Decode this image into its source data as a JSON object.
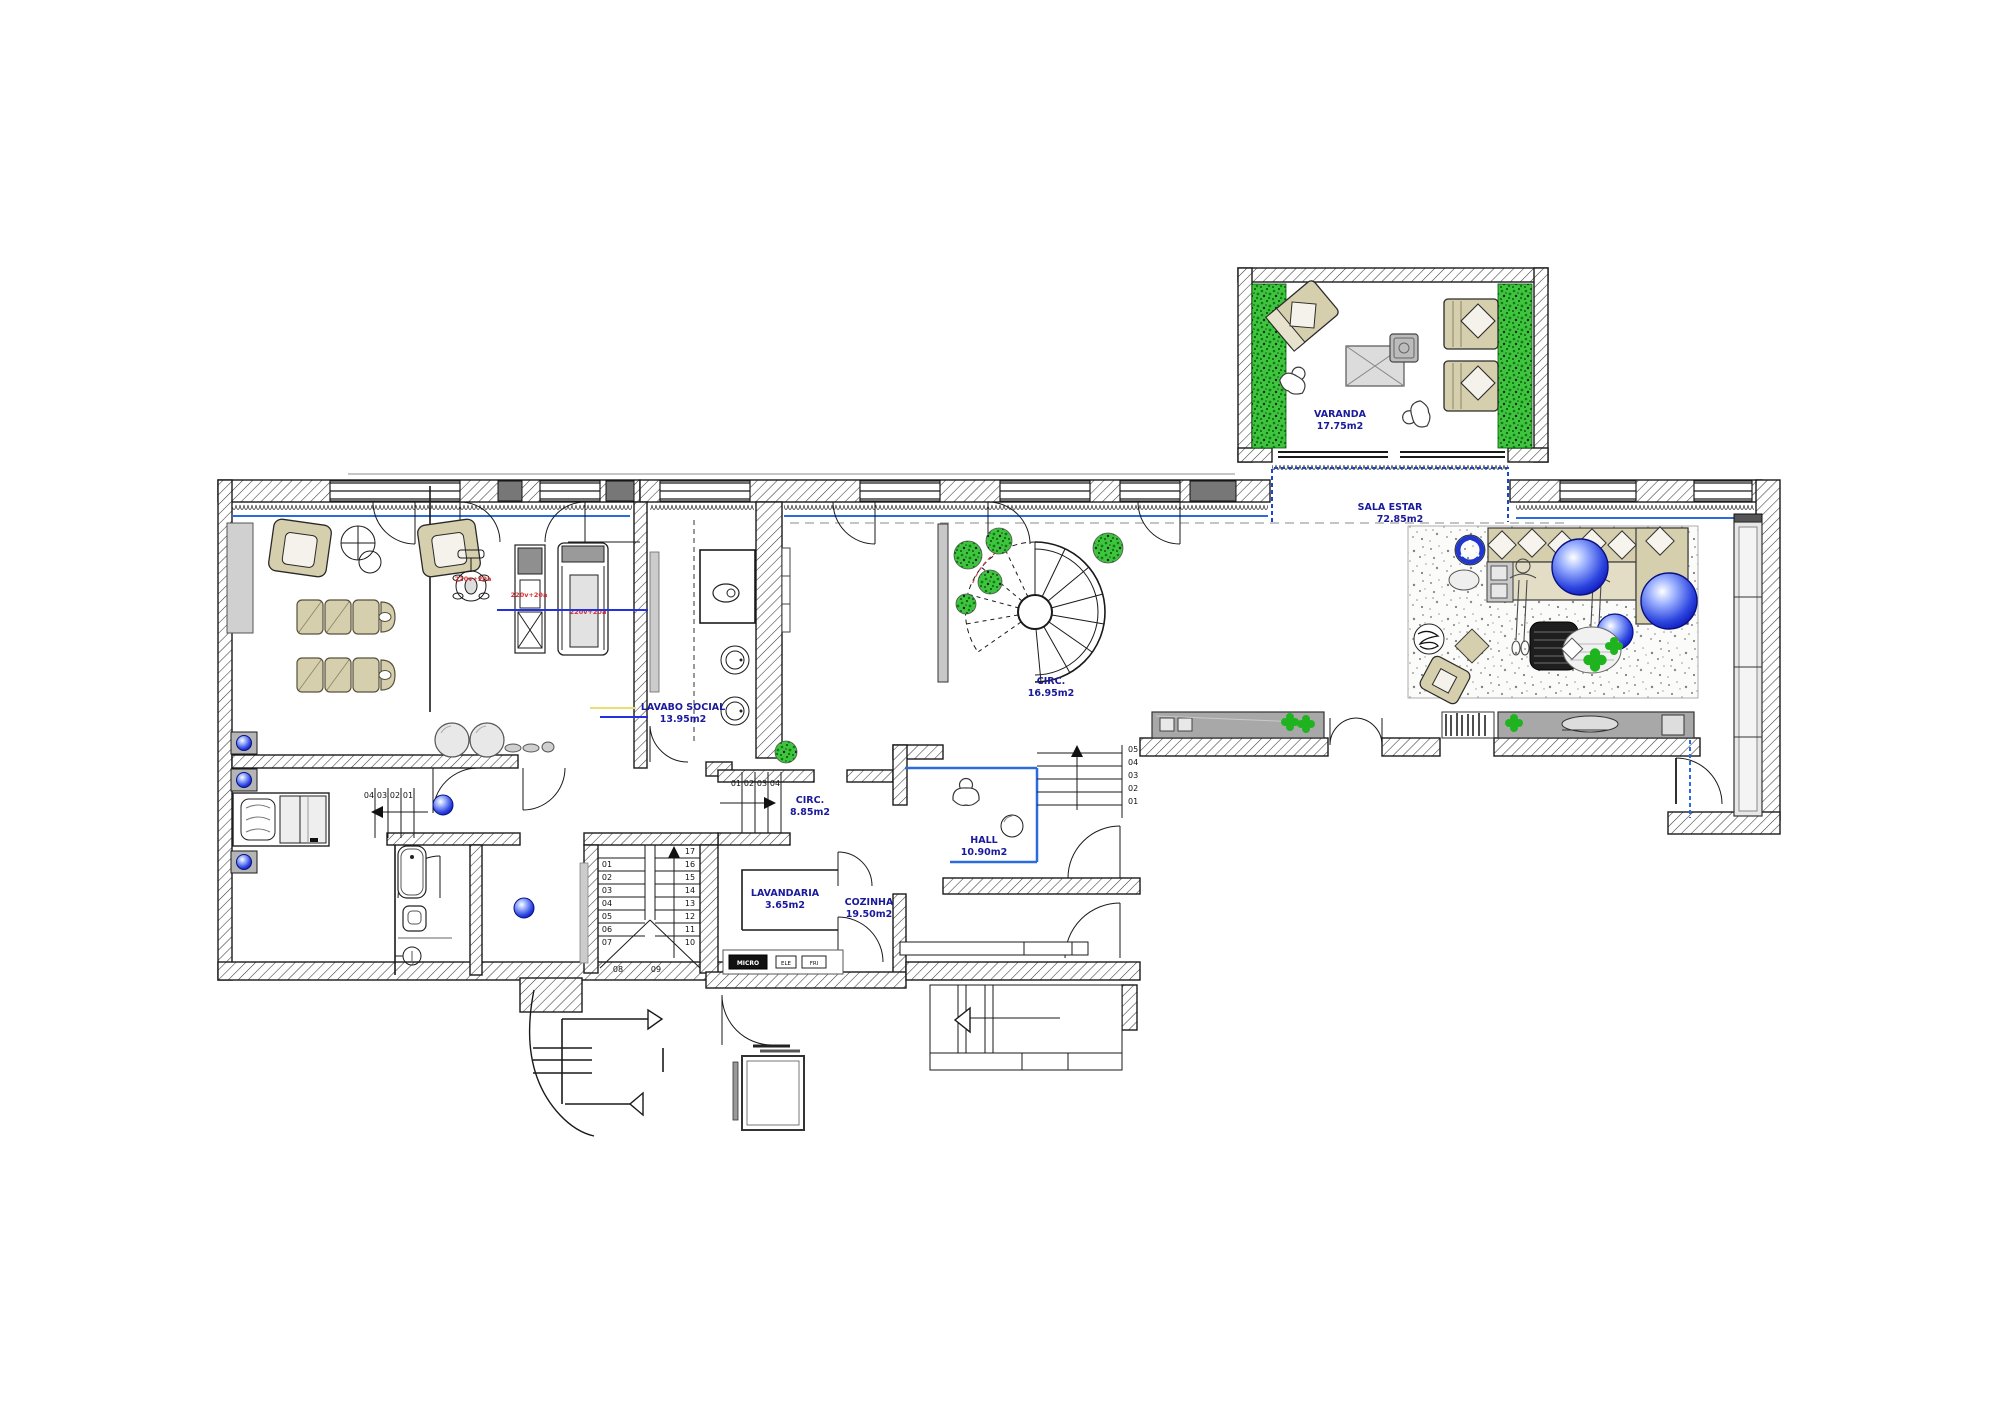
{
  "rooms": {
    "varanda": {
      "name": "VARANDA",
      "area": "17.75m2"
    },
    "sala_estar": {
      "name": "SALA ESTAR",
      "area": "72.85m2"
    },
    "lavabo": {
      "name": "LAVABO SOCIAL",
      "area": "13.95m2"
    },
    "circ_spiral": {
      "name": "CIRC.",
      "area": "16.95m2"
    },
    "circ_lower": {
      "name": "CIRC.",
      "area": "8.85m2"
    },
    "hall": {
      "name": "HALL",
      "area": "10.90m2"
    },
    "lavandaria": {
      "name": "LAVANDARIA",
      "area": "3.65m2"
    },
    "cozinha": {
      "name": "COZINHA",
      "area": "19.50m2"
    }
  },
  "stairs": {
    "main_left": [
      "01",
      "02",
      "03",
      "04",
      "05",
      "06",
      "07"
    ],
    "main_mid": [
      "08",
      "09"
    ],
    "main_right": [
      "17",
      "16",
      "15",
      "14",
      "13",
      "12",
      "11",
      "10"
    ],
    "lower_steps": [
      "01",
      "02",
      "03",
      "04"
    ],
    "bedroom_steps": [
      "04",
      "03",
      "02",
      "01"
    ],
    "hall_steps": [
      "05",
      "04",
      "03",
      "02",
      "01"
    ]
  },
  "notes": {
    "gym": [
      "220v+20a",
      "220v+20a",
      "220v+20a"
    ],
    "kitchen": [
      "MICRO",
      "ELE",
      "FRI"
    ]
  },
  "colors": {
    "label_navy": "#1a1a9c",
    "accent_blue": "#2a6be0",
    "curtain_blue": "#1b46c8",
    "red_note": "#d83030",
    "plant_green": "#1fb41f",
    "beige": "#d6cfae",
    "console_gray": "#a8a8a8",
    "sphere_blue": "#2244ee"
  }
}
